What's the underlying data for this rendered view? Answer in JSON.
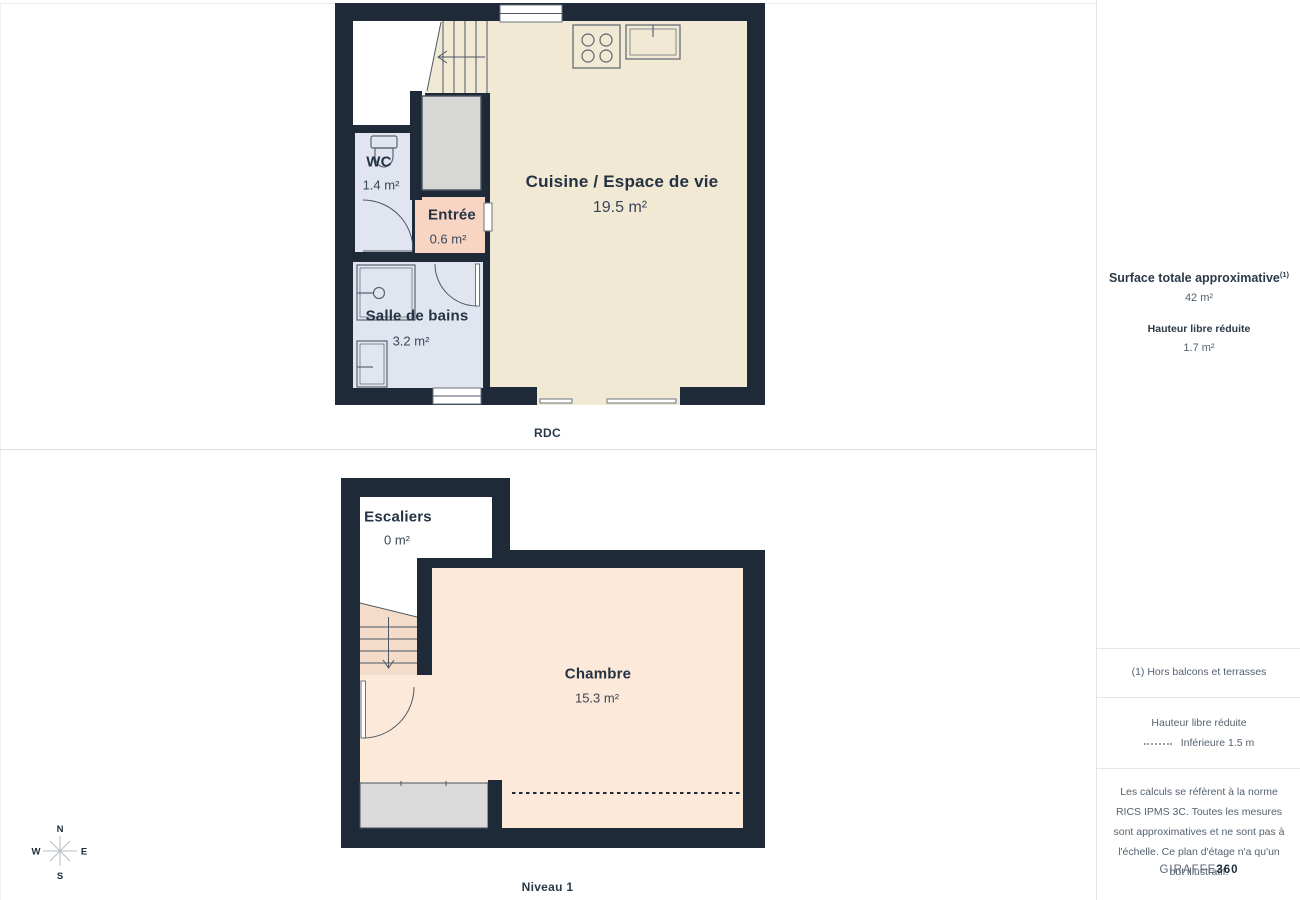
{
  "floors": {
    "rdc": {
      "caption": "RDC",
      "rooms": {
        "cuisine": {
          "name": "Cuisine / Espace de vie",
          "area": "19.5 m²"
        },
        "wc": {
          "name": "WC",
          "area": "1.4 m²"
        },
        "entree": {
          "name": "Entrée",
          "area": "0.6 m²"
        },
        "sdb": {
          "name": "Salle de bains",
          "area": "3.2 m²"
        }
      }
    },
    "niveau1": {
      "caption": "Niveau 1",
      "rooms": {
        "escaliers": {
          "name": "Escaliers",
          "area": "0 m²"
        },
        "chambre": {
          "name": "Chambre",
          "area": "15.3 m²"
        }
      }
    }
  },
  "sidebar": {
    "surface_title": "Surface totale approximative",
    "surface_footnote_marker": "(1)",
    "surface_value": "42 m²",
    "height_title": "Hauteur libre réduite",
    "height_value": "1.7 m²",
    "footnote": "(1) Hors balcons et terrasses",
    "legend_title": "Hauteur libre réduite",
    "legend_item": "Inférieure 1.5 m",
    "disclaimer": "Les calculs se réfèrent à la norme RICS IPMS 3C. Toutes les mesures sont approximatives et ne sont pas à l'échelle. Ce plan d'étage n'a qu'un but illustratif.",
    "brand_name": "GIRAFFE",
    "brand_suffix": "360"
  },
  "compass": {
    "north": "N",
    "east": "E",
    "south": "S",
    "west": "W"
  },
  "colors": {
    "wall": "#1e2a38",
    "kitchen_floor": "#f1e9d4",
    "wet_floor": "#e1e5ef",
    "entree_floor": "#f8d5c3",
    "chambre_floor": "#fce9d9",
    "stairs_floor": "#f3dcca",
    "closet": "#d7d7d5",
    "storage": "#d9dad9",
    "accent_text": "#1f2b38",
    "muted_text": "#55626f"
  }
}
